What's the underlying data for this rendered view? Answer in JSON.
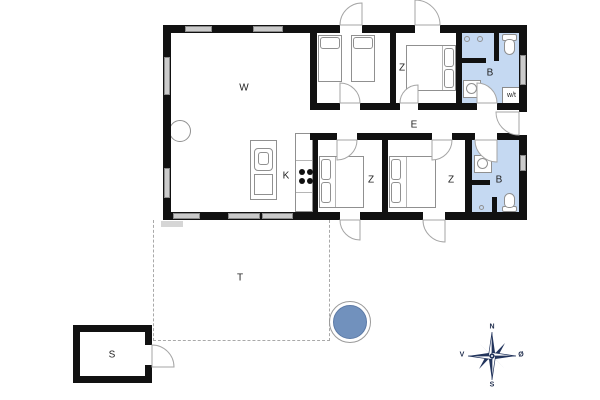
{
  "plan": {
    "living_label": "W",
    "bedroom_z_top_label": "Z",
    "bath_top_label": "B",
    "utility_label": "w/t",
    "hallway_label": "E",
    "kitchen_label": "K",
    "bedroom_z1_label": "Z",
    "bedroom_z2_label": "Z",
    "bath_lower_label": "B",
    "terrace_label": "T",
    "shed_label": "S"
  },
  "compass": {
    "north": "N",
    "east": "Ø",
    "south": "S",
    "west": "V"
  },
  "colors": {
    "bathroom_fill": "#c5d9f2",
    "hot_tub_fill": "#7191bd",
    "wall": "#111111",
    "window": "#cbcbcb",
    "compass": "#22345c",
    "terrace_dash": "#a9a9a9"
  }
}
